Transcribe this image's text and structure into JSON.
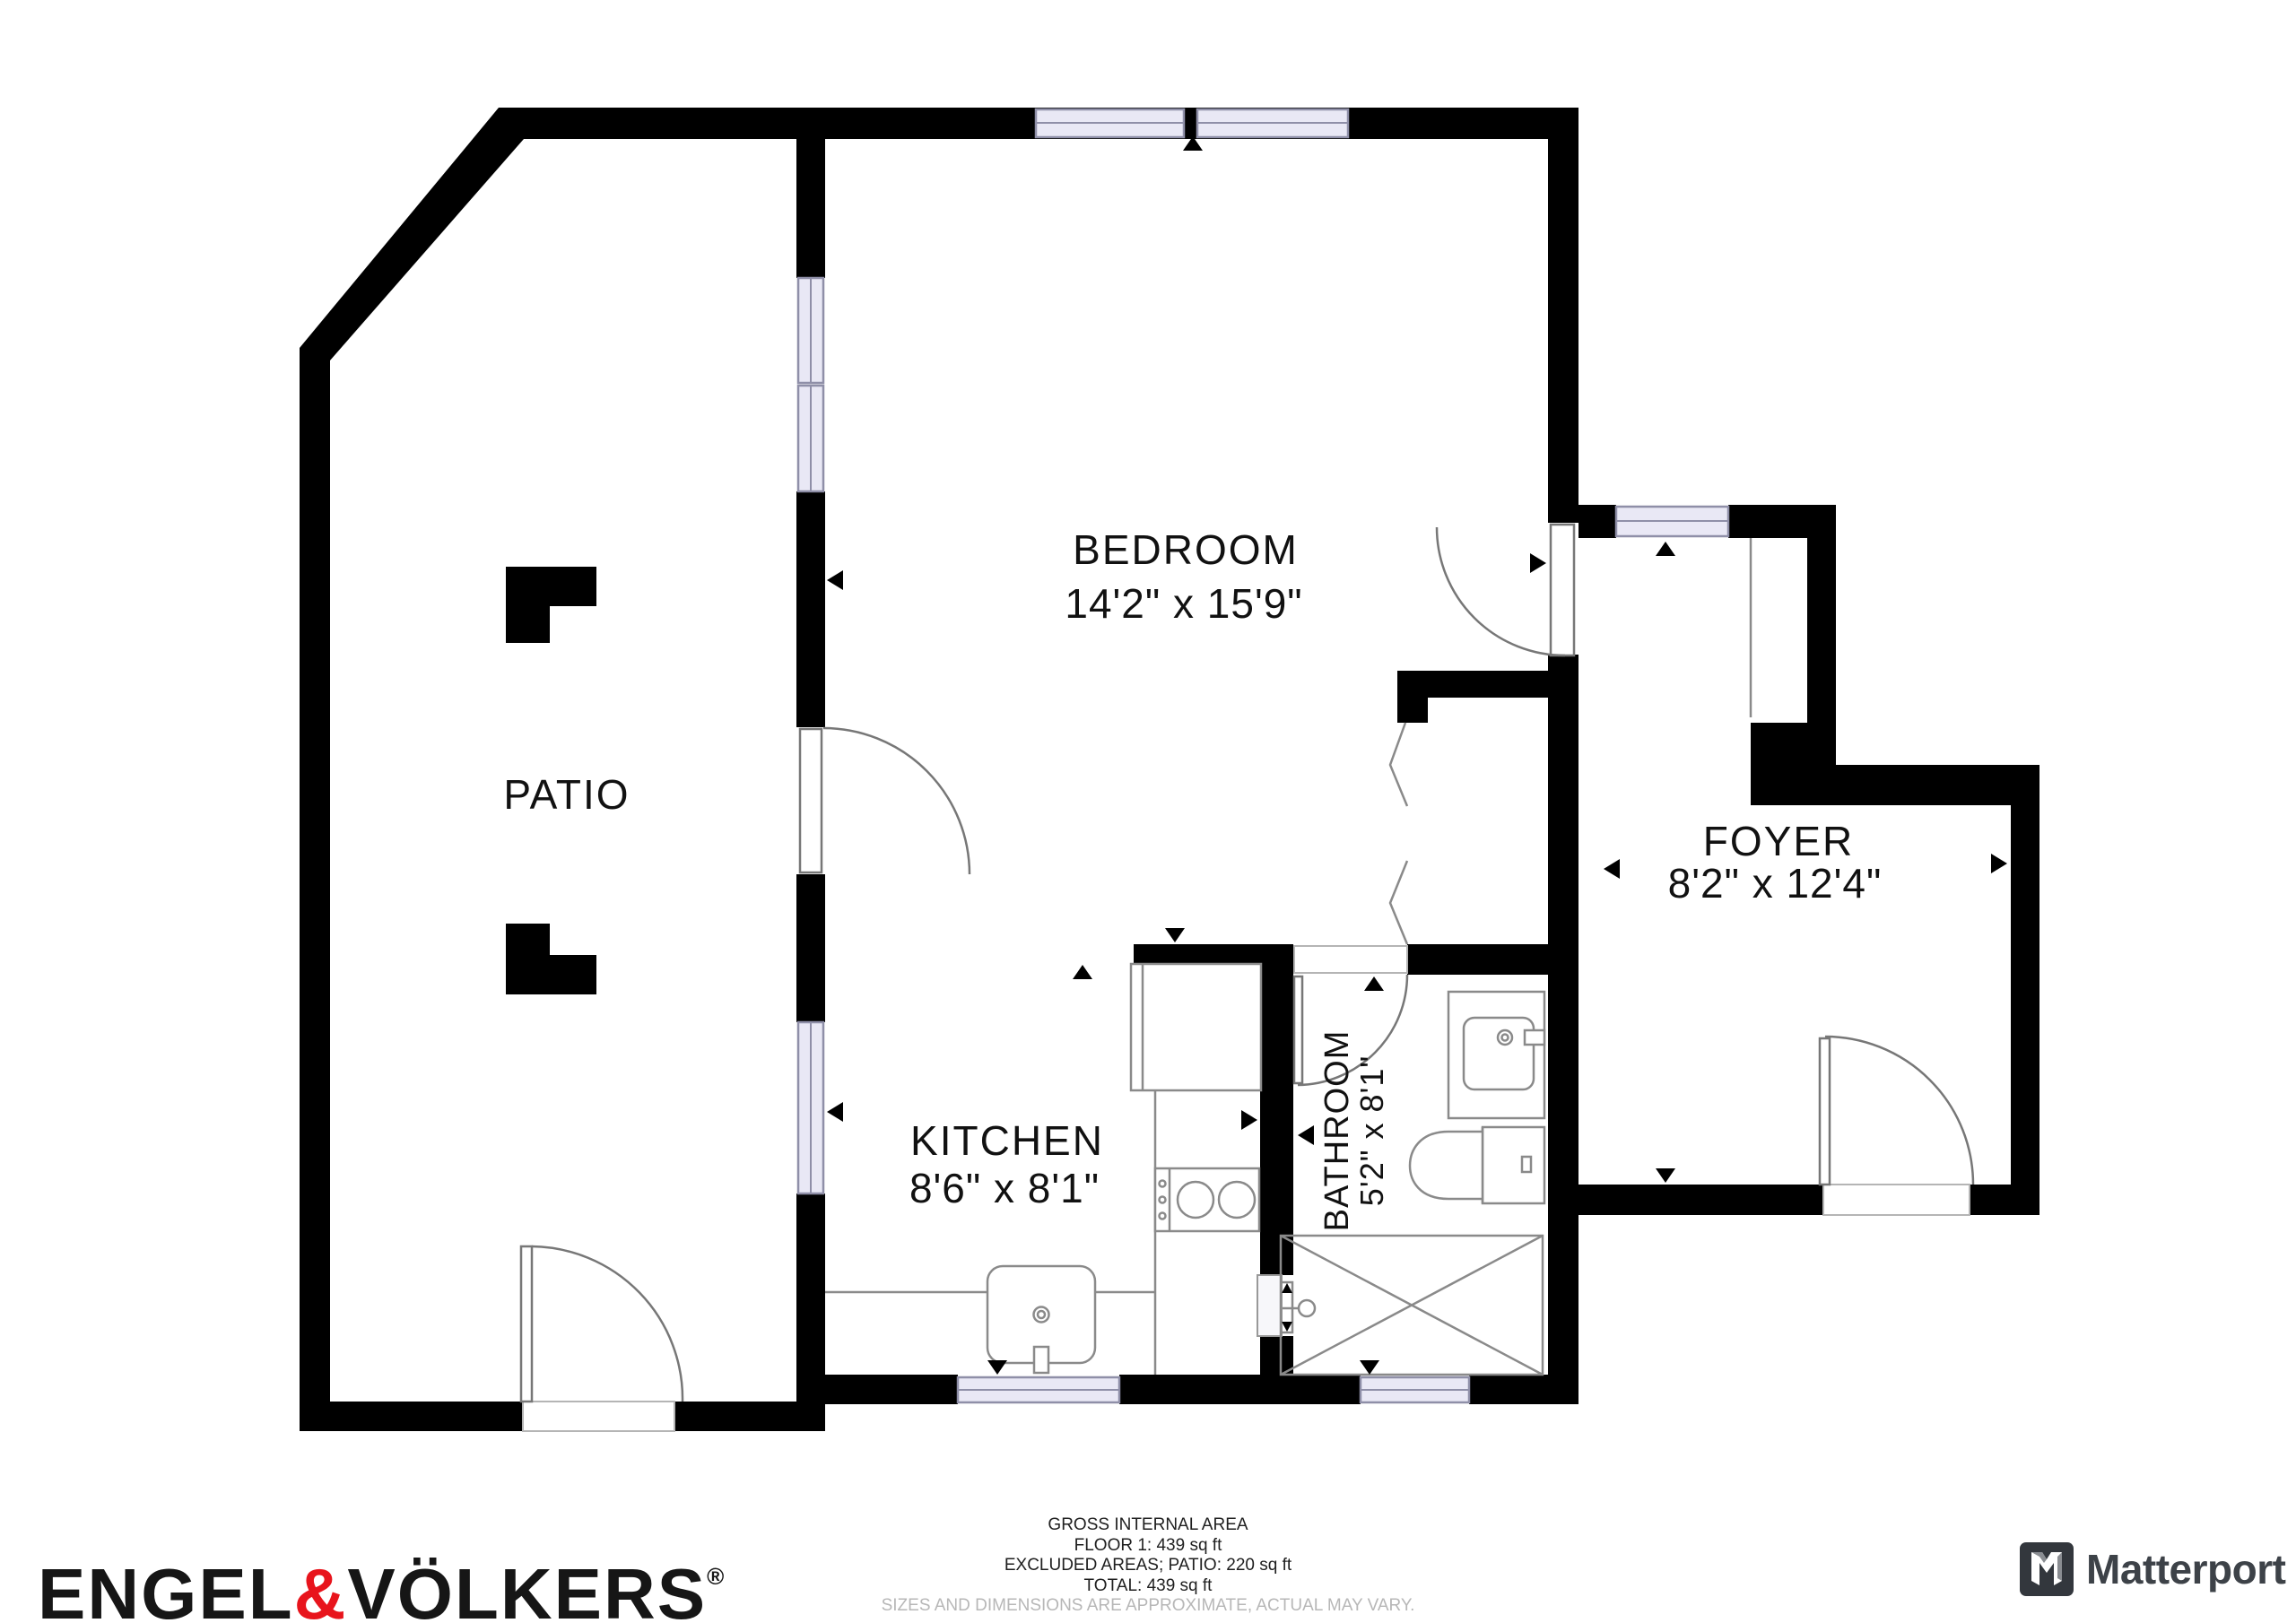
{
  "plan": {
    "rooms": {
      "bedroom": {
        "name": "BEDROOM",
        "dims": "14'2\" x 15'9\""
      },
      "patio": {
        "name": "PATIO"
      },
      "kitchen": {
        "name": "KITCHEN",
        "dims": "8'6\" x 8'1\""
      },
      "bathroom": {
        "name": "BATHROOM",
        "dims": "5'2\" x 8'1\""
      },
      "foyer": {
        "name": "FOYER",
        "dims": "8'2\" x 12'4\""
      }
    }
  },
  "footer": {
    "line1": "GROSS INTERNAL AREA",
    "line2": "FLOOR 1: 439 sq ft",
    "line3": "EXCLUDED AREAS; PATIO: 220 sq ft",
    "line4": "TOTAL: 439 sq ft",
    "disclaimer": "SIZES AND DIMENSIONS ARE APPROXIMATE, ACTUAL MAY VARY."
  },
  "logos": {
    "engel_volkers": {
      "word1": "ENGEL",
      "ampersand": "&",
      "word2": "VÖLKERS",
      "registered": "®"
    },
    "matterport": {
      "text": "Matterport"
    }
  },
  "colors": {
    "wall": "#000000",
    "window_fill": "#e9e8f5",
    "ev_red": "#e8141c",
    "matterport_dark": "#3d4248",
    "disclaimer_gray": "#b7b7b7"
  }
}
